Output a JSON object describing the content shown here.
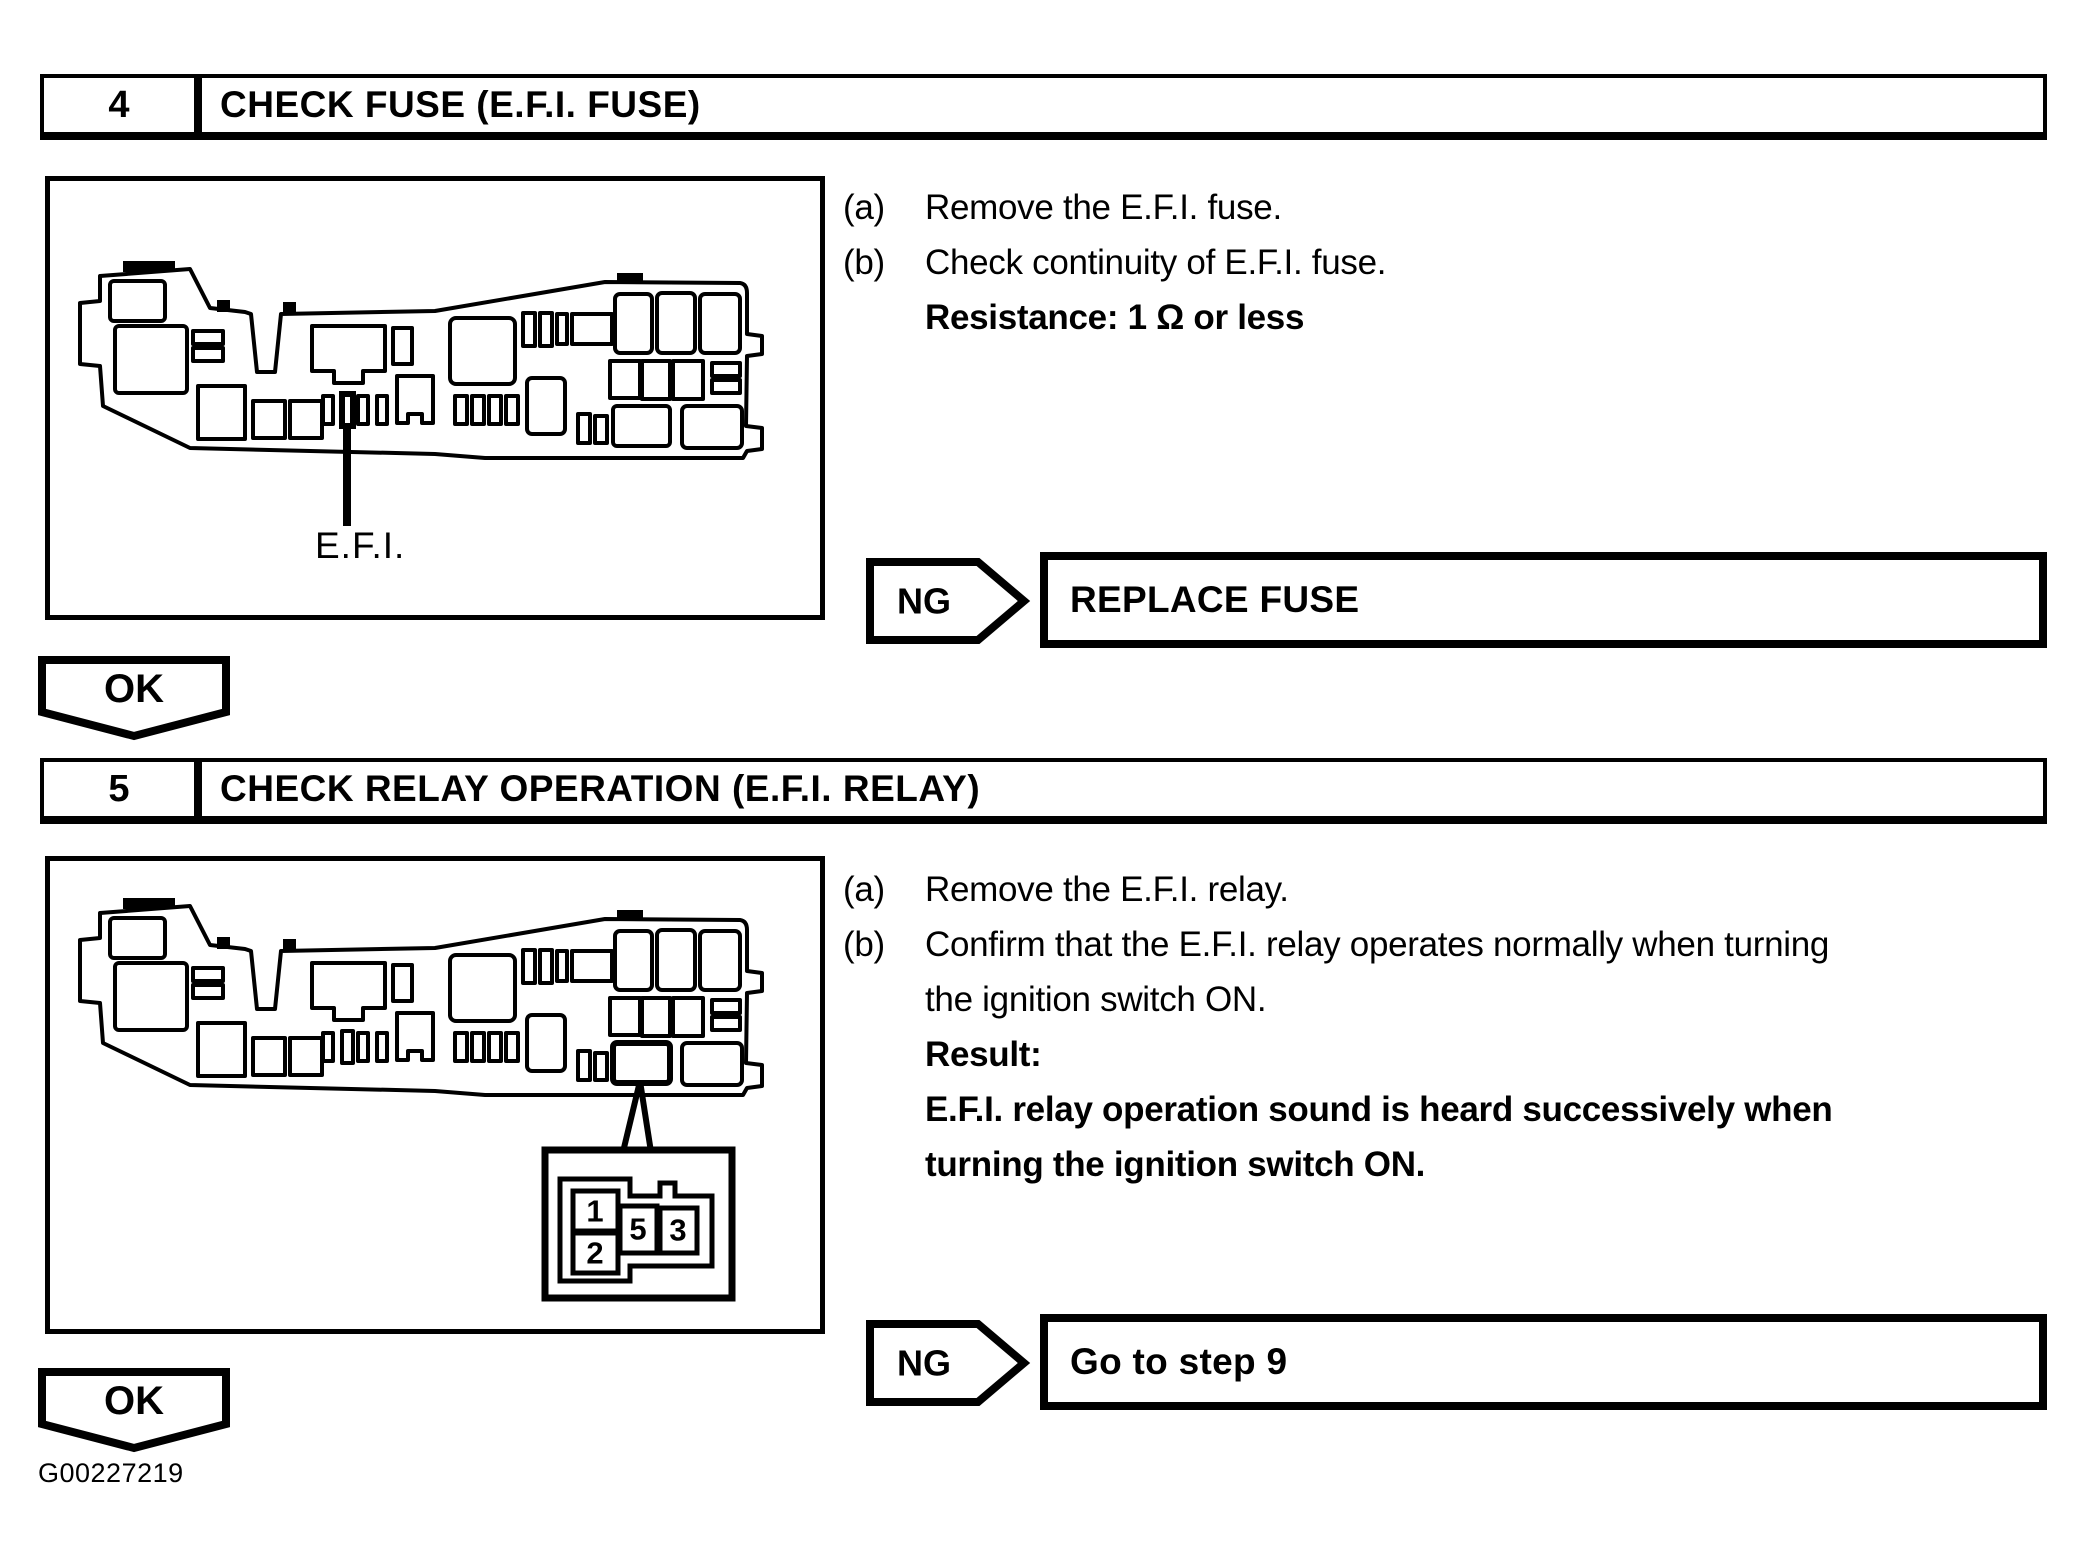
{
  "page": {
    "figure_id": "G00227219"
  },
  "step4": {
    "number": "4",
    "title": "CHECK FUSE (E.F.I. FUSE)",
    "instructions": [
      {
        "label": "(a)",
        "lines": [
          "Remove the E.F.I. fuse."
        ]
      },
      {
        "label": "(b)",
        "lines": [
          "Check continuity of E.F.I. fuse."
        ]
      }
    ],
    "spec": "Resistance: 1 Ω or less",
    "diagram": {
      "label": "E.F.I."
    },
    "ng": {
      "label": "NG",
      "action": "REPLACE FUSE"
    },
    "ok": {
      "label": "OK"
    }
  },
  "step5": {
    "number": "5",
    "title": "CHECK RELAY OPERATION (E.F.I. RELAY)",
    "instructions": [
      {
        "label": "(a)",
        "lines": [
          "Remove the E.F.I. relay."
        ]
      },
      {
        "label": "(b)",
        "lines": [
          "Confirm that the E.F.I. relay operates normally when turning",
          "the ignition switch ON."
        ]
      }
    ],
    "result_label": "Result:",
    "result_lines": [
      "E.F.I. relay operation sound is heard successively when",
      "turning the ignition switch ON."
    ],
    "connector_pins": [
      "1",
      "2",
      "5",
      "3"
    ],
    "ng": {
      "label": "NG",
      "action": "Go to step 9"
    },
    "ok": {
      "label": "OK"
    }
  }
}
